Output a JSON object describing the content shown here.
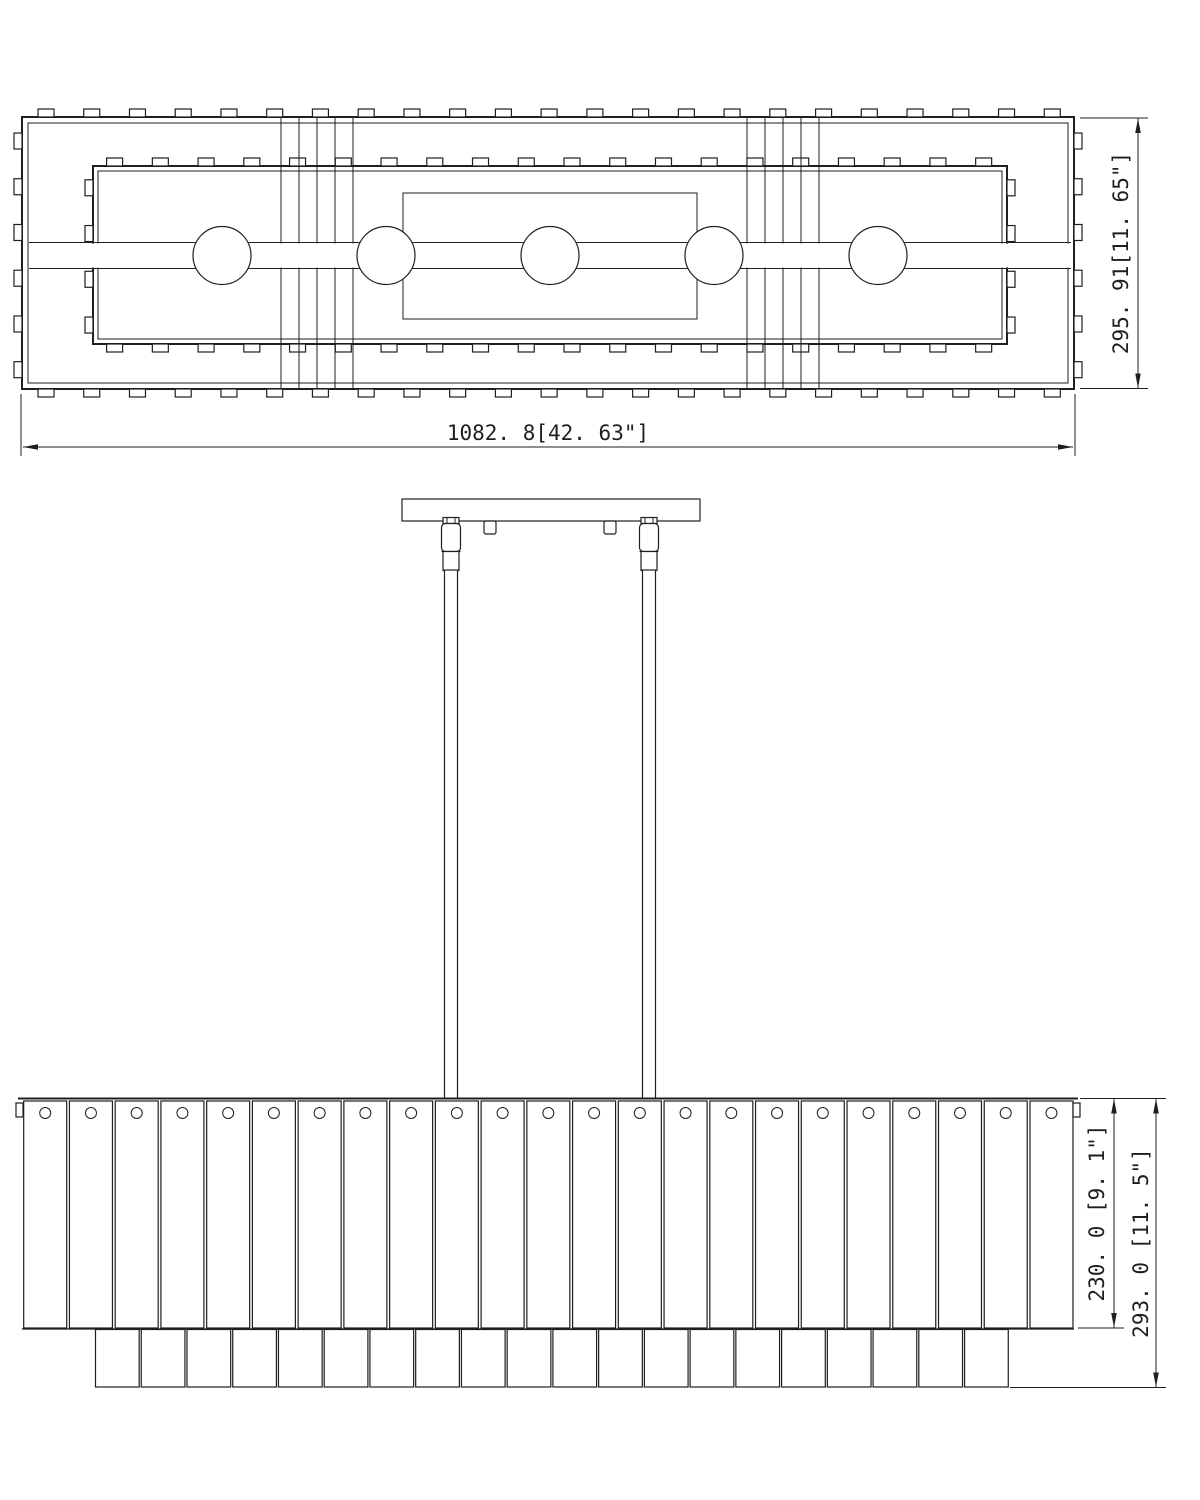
{
  "drawing": {
    "background": "#ffffff",
    "line_color": "#1f1f1f",
    "views": {
      "top": {
        "label": "plan view",
        "light_count": 5,
        "light_centers_x": [
          222,
          386,
          550,
          714,
          878
        ],
        "crossbar_count": 2,
        "crossbar_line_xs": [
          281,
          299,
          317,
          335,
          353
        ],
        "outer_tab_count": 23,
        "inner_tab_count": 20,
        "outer_side_tab_count": 6,
        "inner_side_tab_count": 4,
        "dim_width": "1082. 8[42. 63\"]",
        "dim_height": "295. 91[11. 65\"]"
      },
      "side": {
        "label": "elevation view",
        "rod_count": 2,
        "rod_centers_x": [
          451,
          649
        ],
        "canopy_tab_centers_x": [
          490,
          610
        ],
        "slat_count": 23,
        "lower_slat_count": 20,
        "dim_shade_height": "230. 0 [9. 1\"]",
        "dim_overall_height": "293. 0 [11. 5\"]"
      }
    }
  }
}
